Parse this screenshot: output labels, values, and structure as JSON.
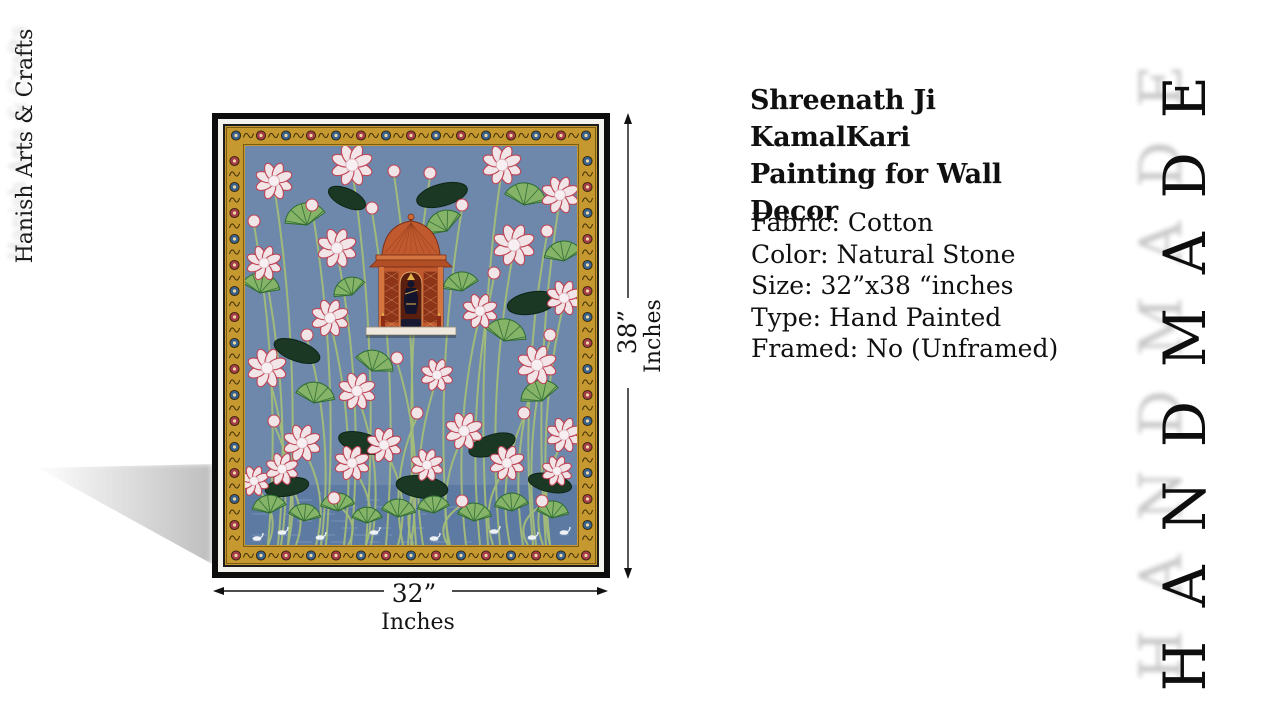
{
  "brand": {
    "vertical_text": "Hanish Arts & Crafts"
  },
  "watermark": {
    "vertical_text": "HANDMADE"
  },
  "product": {
    "title_line1": "Shreenath Ji KamalKari",
    "title_line2": "Painting for Wall Decor",
    "specs": [
      "Fabric: Cotton",
      "Color: Natural Stone",
      "Size: 32”x38 “inches",
      "Type: Hand Painted",
      "Framed: No (Unframed)"
    ]
  },
  "dimensions": {
    "height_label": "38”",
    "height_unit": "Inches",
    "width_label": "32”",
    "width_unit": "Inches"
  },
  "painting": {
    "subject": "Shreenath Ji Pichwai lotus-pond (KamalKari) painting in gold floral border",
    "colors": {
      "frame_black": "#0d0d0d",
      "mat_white": "#f5f3ee",
      "border_gold": "#c5992f",
      "border_gold_dark": "#7c5c10",
      "field_blue": "#6d88ab",
      "pond_blue": "#5d7aa2",
      "lotus_petal": "#f2e5e8",
      "lotus_edge": "#c04455",
      "pad_light": "#85b468",
      "pad_dark": "#1a3823",
      "stem_green": "#a3bd78",
      "shrine_orange": "#c05a2e",
      "shrine_dark": "#7c2f16",
      "figure_dark": "#14142c",
      "rosette_red": "#a63b4a",
      "rosette_blue": "#3a628f",
      "swan_white": "#eef2f5",
      "shelf_white": "#efe9dd"
    }
  }
}
